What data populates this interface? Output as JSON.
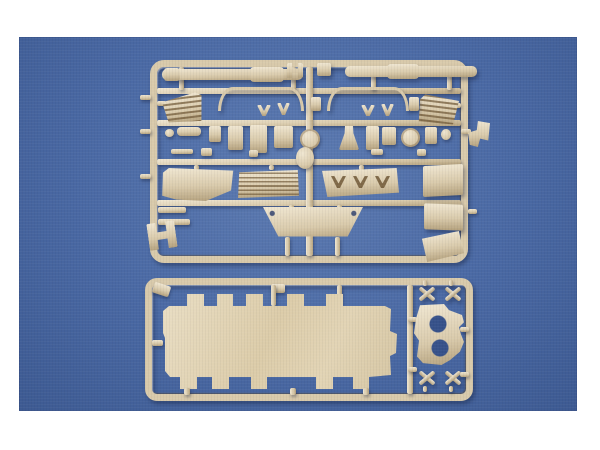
{
  "scene": {
    "type": "product-photo",
    "subject": "tan injection-molded model kit sprues on a blue studio backdrop with white border",
    "colors": {
      "page-bg": "#ffffff",
      "backdrop-blue": "#4a69a4",
      "backdrop-blue-light": "#5e7cb2",
      "backdrop-blue-dark": "#3d5a92",
      "hole-blue": "#37528a",
      "plastic-light": "#f0e7d2",
      "plastic-mid": "#d9caab",
      "plastic-dark": "#b3a07c",
      "part-shadow": "rgba(16,26,56,0.40)"
    }
  },
  "sprues": {
    "top": {
      "label": "detail parts sprue: gun barrels, mesh grilles, bow rails, small fittings, louvered and chevron plates, glacis plate",
      "parts": [
        "gun-barrel-left",
        "gun-barrel-right",
        "mesh-grille-left",
        "mesh-grille-right",
        "bow-rail-left",
        "bow-rail-right",
        "small-fittings",
        "louvered-plate",
        "chevron-plate",
        "side-plate",
        "hatch-plates",
        "glacis-plate",
        "h-bracket"
      ]
    },
    "bottom": {
      "label": "hull plate sprue: castellated hull plate, twin-hole mount, four cross links",
      "parts": [
        "castellated-hull-plate",
        "twin-hole-mount",
        "cross-link",
        "cross-link",
        "cross-link",
        "cross-link"
      ]
    }
  }
}
